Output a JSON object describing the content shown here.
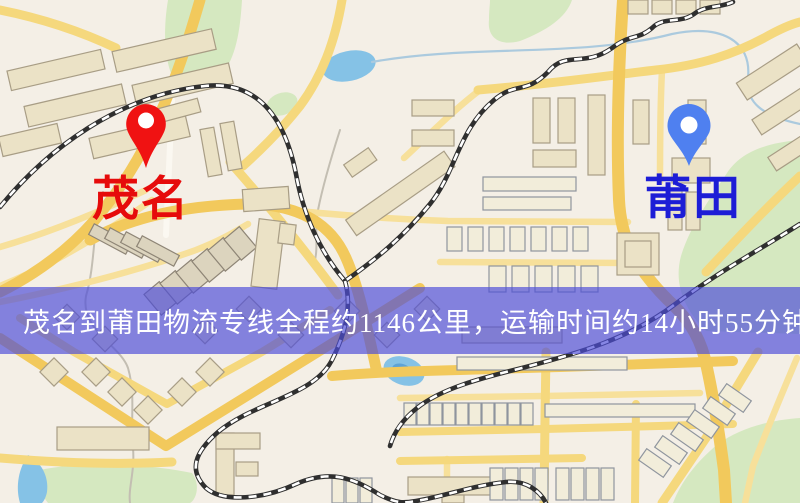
{
  "banner": {
    "text": "茂名到莆田物流专线全程约1146公里，运输时间约14小时55分钟."
  },
  "markers": {
    "origin": {
      "label": "茂名",
      "pin_icon": "red-map-pin"
    },
    "destination": {
      "label": "莆田",
      "pin_icon": "blue-map-pin"
    }
  },
  "map_colors": {
    "base": "#f4efe6",
    "road_major": "#f2c95c",
    "road_mid": "#f5d87d",
    "road_minor": "#f7e09a",
    "green": "#d5e8c0",
    "water": "#85c2e6",
    "water_deep": "#5ea3d6",
    "building": "#ebe2c6",
    "building_outline": "#a89d85",
    "building_light": "#f2edda",
    "building_light_outline": "#8f959e",
    "building_dark": "#dcd4be",
    "building_dark_outline": "#8e8576",
    "railway": "#2f2f2f",
    "railway_dash": "#ffffff",
    "stream": "#c3beb2",
    "river": "#abcade",
    "banner_bg": "rgba(76,76,216,0.68)",
    "banner_text": "#ffffff",
    "origin_pin": "#f01212",
    "origin_label": "#e60b0b",
    "dest_pin": "#4f80f0",
    "dest_label": "#1d1dd6"
  }
}
